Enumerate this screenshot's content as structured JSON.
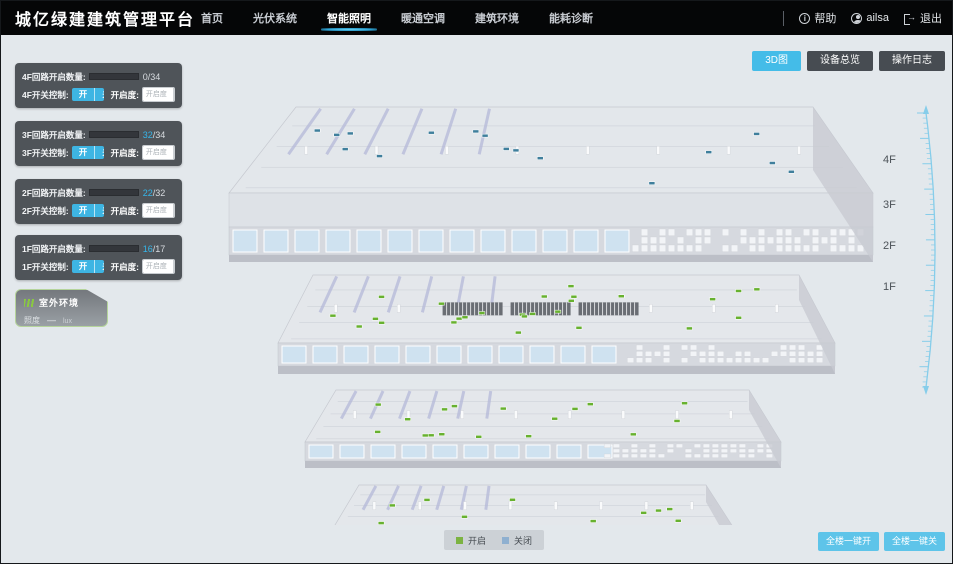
{
  "header": {
    "title": "城亿绿建建筑管理平台",
    "nav": [
      {
        "label": "首页",
        "active": false
      },
      {
        "label": "光伏系统",
        "active": false
      },
      {
        "label": "智能照明",
        "active": true
      },
      {
        "label": "暖通空调",
        "active": false
      },
      {
        "label": "建筑环境",
        "active": false
      },
      {
        "label": "能耗诊断",
        "active": false
      }
    ],
    "help_label": "帮助",
    "user_name": "ailsa",
    "logout_label": "退出"
  },
  "floor_panels": [
    {
      "floor": "4F",
      "count_label": "4F回路开启数量:",
      "count_on": "0",
      "count_rest": "/34",
      "ratio": 0,
      "switch_label": "4F开关控制:",
      "on_label": "开",
      "off_label": "关",
      "dim_label": "开启度:",
      "dim_placeholder": "开启度",
      "percent_label": "%"
    },
    {
      "floor": "3F",
      "count_label": "3F回路开启数量:",
      "count_on": "32",
      "count_rest": "/34",
      "ratio": 0.94,
      "switch_label": "3F开关控制:",
      "on_label": "开",
      "off_label": "关",
      "dim_label": "开启度:",
      "dim_placeholder": "开启度",
      "percent_label": "%"
    },
    {
      "floor": "2F",
      "count_label": "2F回路开启数量:",
      "count_on": "22",
      "count_rest": "/32",
      "ratio": 0.69,
      "switch_label": "2F开关控制:",
      "on_label": "开",
      "off_label": "关",
      "dim_label": "开启度:",
      "dim_placeholder": "开启度",
      "percent_label": "%"
    },
    {
      "floor": "1F",
      "count_label": "1F回路开启数量:",
      "count_on": "16",
      "count_rest": "/17",
      "ratio": 0.94,
      "switch_label": "1F开关控制:",
      "on_label": "开",
      "off_label": "关",
      "dim_label": "开启度:",
      "dim_placeholder": "开启度",
      "percent_label": "%"
    }
  ],
  "outdoor": {
    "title": "室外环境",
    "metric_label": "照度",
    "value": "—",
    "unit": "lux"
  },
  "view_buttons": [
    {
      "label": "3D图",
      "active": true
    },
    {
      "label": "设备总览",
      "active": false
    },
    {
      "label": "操作日志",
      "active": false
    }
  ],
  "floor_axis": [
    "4F",
    "3F",
    "2F",
    "1F"
  ],
  "legend": [
    {
      "label": "开启",
      "color": "#7cb342"
    },
    {
      "label": "关闭",
      "color": "#8fb0d0"
    }
  ],
  "bottom_actions": [
    {
      "label": "全楼一键开"
    },
    {
      "label": "全楼一键关"
    }
  ],
  "building": {
    "floor_blocks": [
      {
        "label": "4F",
        "dot_color": "#3f7f9c",
        "dot_count": 16
      },
      {
        "label": "3F",
        "dot_color": "#67b12f",
        "dot_count": 26
      },
      {
        "label": "2F",
        "dot_color": "#67b12f",
        "dot_count": 17
      },
      {
        "label": "1F",
        "dot_color": "#67b12f",
        "dot_count": 10
      }
    ],
    "colors": {
      "face": "#e4e6eb",
      "band": "#d6d9df",
      "window": "#cfe2f0",
      "wall": "#b4b8d8",
      "frame": "#ffffff",
      "base": "#bcbfc7",
      "scale_line": "#86cdea"
    }
  }
}
